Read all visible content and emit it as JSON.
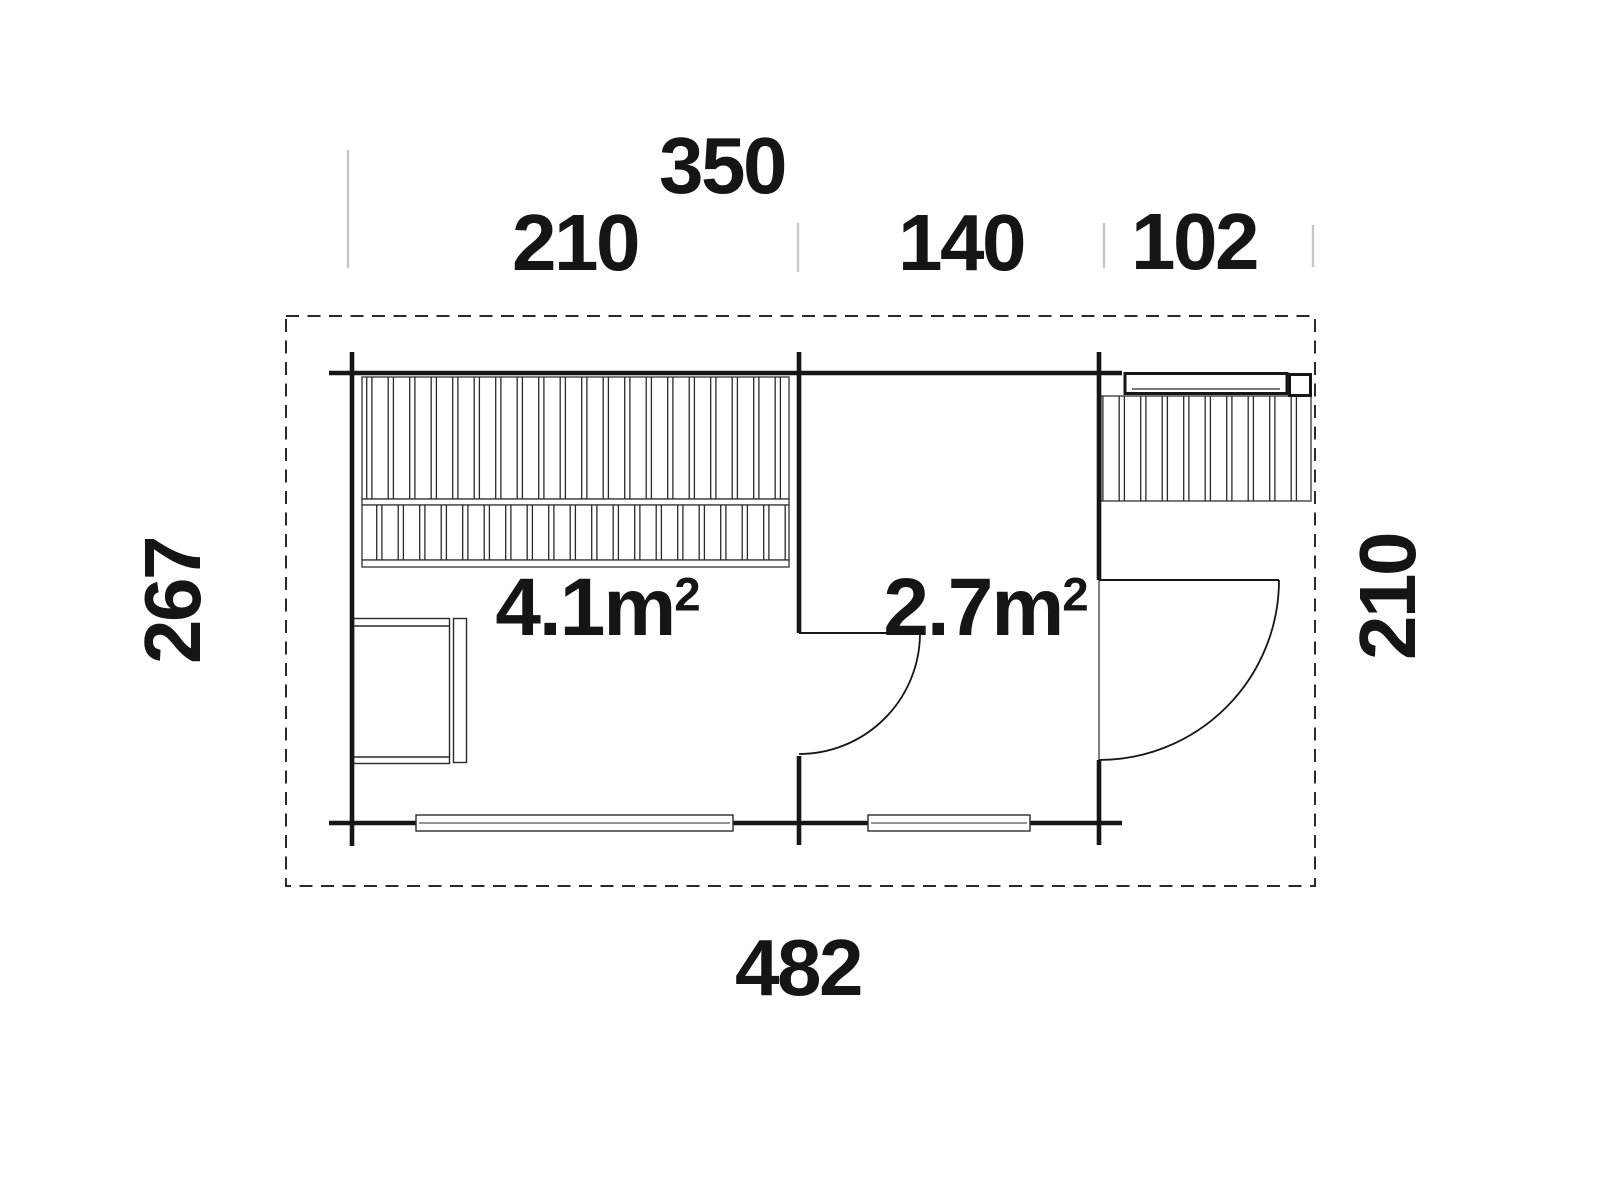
{
  "drawing": {
    "title": "floor-plan",
    "colors": {
      "background": "#ffffff",
      "line": "#161616",
      "thin_line": "#2a2a2a",
      "tick": "#c6c6c6",
      "text": "#151515"
    },
    "dimensions": {
      "top_total": "350",
      "top_left_section": "210",
      "top_mid_section": "140",
      "top_right_section": "102",
      "bottom_total": "482",
      "left_height": "267",
      "right_height": "210"
    },
    "rooms": [
      {
        "area_value": "4.1",
        "area_unit": "m",
        "area_sup": "2"
      },
      {
        "area_value": "2.7",
        "area_unit": "m",
        "area_sup": "2"
      }
    ]
  }
}
